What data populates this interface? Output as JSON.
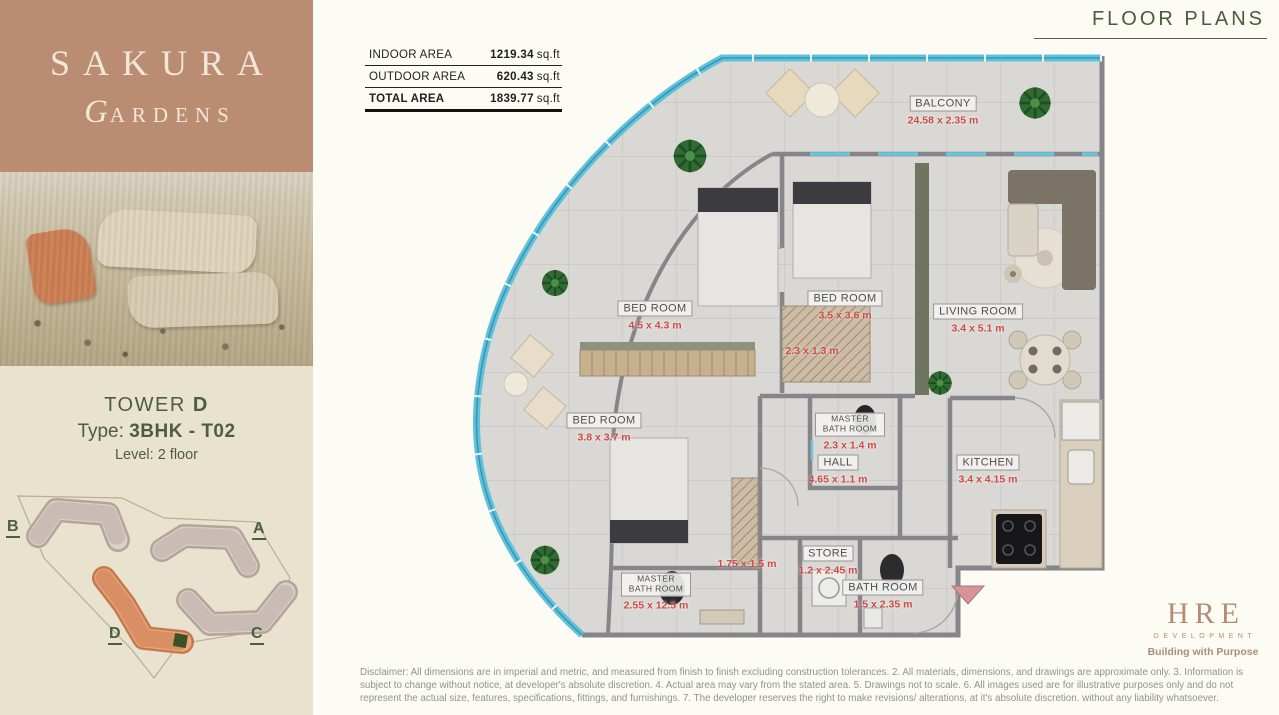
{
  "header": {
    "title": "FLOOR PLANS"
  },
  "brand": {
    "name": "SAKURA",
    "subtitle": "GARDENS"
  },
  "unit_info": {
    "tower_label": "TOWER",
    "tower_value": "D",
    "type_label": "Type:",
    "type_value": "3BHK - T02",
    "level_label": "Level:",
    "level_value": "2 floor"
  },
  "area_table": {
    "rows": [
      {
        "label": "INDOOR AREA",
        "value": "1219.34",
        "unit": "sq.ft"
      },
      {
        "label": "OUTDOOR AREA",
        "value": "620.43",
        "unit": "sq.ft"
      },
      {
        "label": "TOTAL AREA",
        "value": "1839.77",
        "unit": "sq.ft"
      }
    ]
  },
  "site_plan": {
    "labels": [
      "B",
      "A",
      "D",
      "C"
    ]
  },
  "plan": {
    "rooms": [
      {
        "name": "BALCONY",
        "dims": "24.58 x 2.35 m"
      },
      {
        "name": "BED ROOM",
        "dims": "4.5 x 4.3 m"
      },
      {
        "name": "BED ROOM",
        "dims": "3.5 x 3.6 m"
      },
      {
        "name": "LIVING ROOM",
        "dims": "3.4 x 5.1 m"
      },
      {
        "name": "MASTER BATH ROOM",
        "dims": "2.3 x 1.4 m"
      },
      {
        "name": "BED ROOM",
        "dims": "3.8 x 3.7 m"
      },
      {
        "name": "HALL",
        "dims": "4.65 x 1.1 m"
      },
      {
        "name": "KITCHEN",
        "dims": "3.4 x 4.15 m"
      },
      {
        "name": "STORE",
        "dims": "1.2 x 2.45 m"
      },
      {
        "name": "BATH ROOM",
        "dims": "1.5 x 2.35 m"
      },
      {
        "name": "MASTER BATH ROOM",
        "dims": "2.55 x 12.5 m"
      }
    ],
    "extra_dims": [
      "2.3 x 1.3 m",
      "1.75 x 1.5 m"
    ]
  },
  "developer": {
    "name": "HRE",
    "division": "DEVELOPMENT",
    "tagline": "Building with Purpose"
  },
  "disclaimer": "Disclaimer: All dimensions are in imperial and metric, and measured from finish to finish excluding construction tolerances. 2. All materials, dimensions, and drawings are approximate only. 3. Information is subject to change without notice, at developer's absolute discretion. 4. Actual area may vary from the stated area. 5. Drawings not to scale. 6. All images used are for illustrative purposes only and do not represent the actual size, features, specifications, fittings, and furnishings. 7. The developer reserves the right to make revisions/ alterations, at it's absolute discretion. without any liability whatsoever.",
  "colors": {
    "brand_tan": "#ba8d73",
    "accent_green": "#4d5f3a",
    "dimension_red": "#cf4a42",
    "glass_cyan": "#5ec3da",
    "highlight_orange": "#eea87e",
    "developer_rose": "#b58b71"
  }
}
